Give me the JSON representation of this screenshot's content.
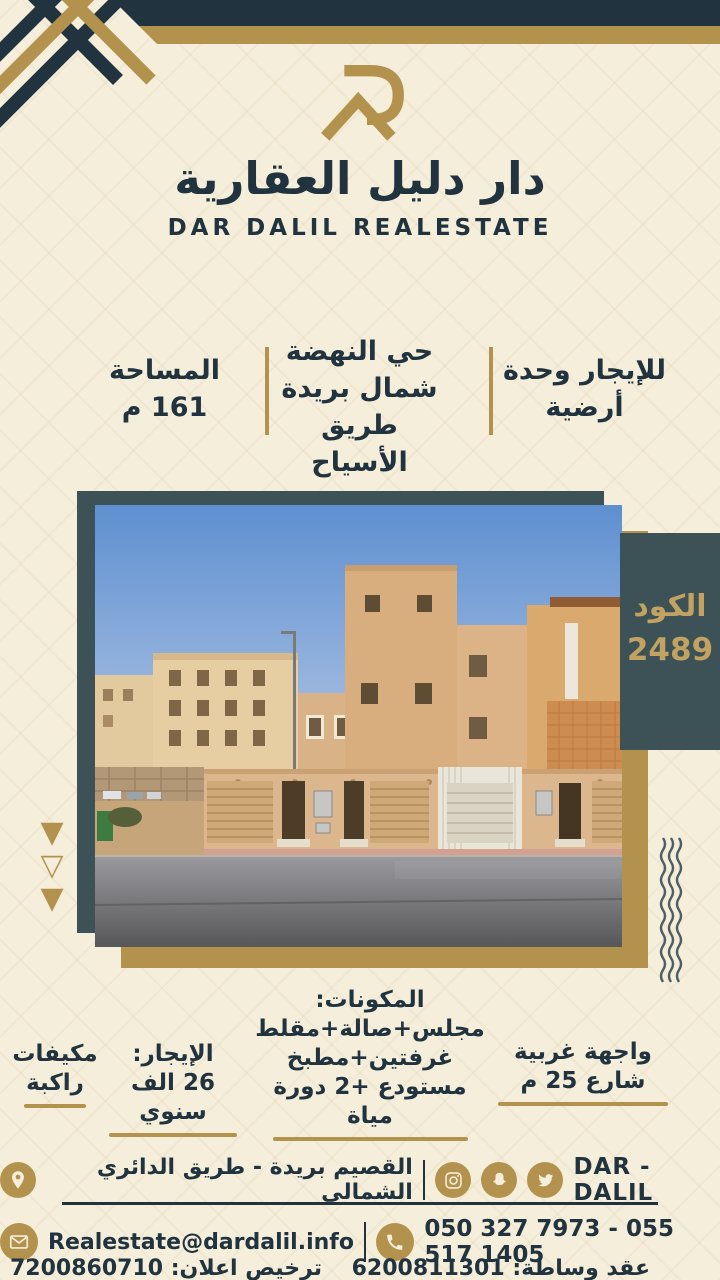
{
  "theme": {
    "cream": "#f5eedb",
    "navy": "#20333e",
    "gold": "#b3924d",
    "teal": "#3d5256",
    "badge_text": "#c2a260"
  },
  "header": {
    "brand_ar": "دار دليل العقارية",
    "brand_en": "DAR DALIL REALESTATE"
  },
  "summary": {
    "offer": {
      "line1": "للإيجار وحدة",
      "line2": "أرضية"
    },
    "location": {
      "line1": "حي النهضة",
      "line2": "شمال بريدة",
      "line3": "طريق الأسياح"
    },
    "area": {
      "line1": "المساحة",
      "line2": "161 م"
    }
  },
  "photo_section": {
    "code_label": "الكود",
    "code_value": "2489"
  },
  "details": {
    "facade": {
      "line1": "واجهة غربية",
      "line2": "شارع 25 م"
    },
    "components": {
      "title": "المكونات:",
      "line1": "مجلس+صالة+مقلط",
      "line2": "غرفتين+مطبخ",
      "line3": "مستودع +2 دورة مياة"
    },
    "rent": {
      "line1": "الإيجار:",
      "line2": "26 الف سنوي"
    },
    "ac": {
      "line1": "مكيفات",
      "line2": "راكبة"
    }
  },
  "footer": {
    "address": "القصيم بريدة - طريق الدائري الشمالي",
    "brand": "DAR - DALIL",
    "email": "Realestate@dardalil.info",
    "phones": "050 327 7973 - 055 517 1405",
    "brokerage_contract": "عقد وساطة: 6200811301",
    "ad_license": "ترخيص اعلان: 7200860710"
  }
}
